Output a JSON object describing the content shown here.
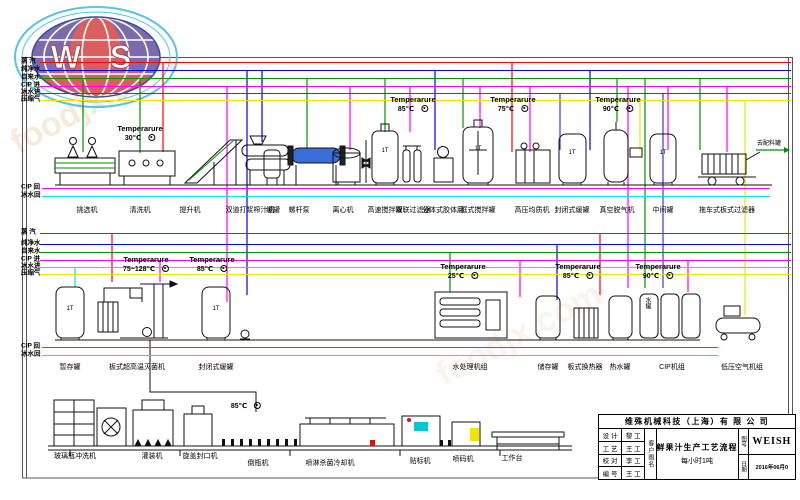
{
  "watermark": {
    "text": "foodjx.com"
  },
  "logo": {
    "letters": "W S"
  },
  "pipes": {
    "top": {
      "x1": 40,
      "x2": 791,
      "lines": [
        {
          "label": "蒸  汽",
          "color": "#ff0000",
          "y": 62
        },
        {
          "label": "纯净水",
          "color": "#0000ee",
          "y": 70
        },
        {
          "label": "自来水",
          "color": "#009100",
          "y": 78
        },
        {
          "label": "CIP 进",
          "color": "#ff00ff",
          "y": 86
        },
        {
          "label": "冰水进",
          "color": "#4a30e0",
          "y": 93
        },
        {
          "label": "压缩气",
          "color": "#f0e400",
          "y": 100
        }
      ]
    },
    "return_top": {
      "x1": 42,
      "x2": 770,
      "lines": [
        {
          "label": "CIP 回",
          "color": "#ff00ff",
          "y": 188
        },
        {
          "label": "冰水回",
          "color": "#00e5ee",
          "y": 196
        }
      ]
    },
    "mid": {
      "x1": 40,
      "x2": 791,
      "lines": [
        {
          "label": "蒸  汽",
          "color": "#ff0000",
          "y": 233
        },
        {
          "label": "纯净水",
          "color": "#0000ee",
          "y": 244
        },
        {
          "label": "自来水",
          "color": "#009100",
          "y": 252
        },
        {
          "label": "CIP 进",
          "color": "#ff00ff",
          "y": 260
        },
        {
          "label": "冰水进",
          "color": "#00e5ee",
          "y": 267
        },
        {
          "label": "压缩气",
          "color": "#f0e400",
          "y": 274
        }
      ]
    },
    "return_mid": {
      "x1": 42,
      "x2": 718,
      "lines": [
        {
          "label": "CIP 回",
          "color": "#ff00ff",
          "y": 347
        },
        {
          "label": "冰水回",
          "color": "#00e5ee",
          "y": 355
        }
      ]
    }
  },
  "equipment_row1": {
    "y": 207,
    "items": [
      {
        "text": "挑选机",
        "x": 87
      },
      {
        "text": "清洗机",
        "x": 140
      },
      {
        "text": "提升机",
        "x": 190
      },
      {
        "text": "双道打浆榨汁机",
        "x": 250
      },
      {
        "text": "缓罐",
        "x": 273
      },
      {
        "text": "螺杆泵",
        "x": 299
      },
      {
        "text": "离心机",
        "x": 343
      },
      {
        "text": "高速搅拌罐",
        "x": 385
      },
      {
        "text": "双联过滤器",
        "x": 413
      },
      {
        "text": "分体式胶体磨",
        "x": 443
      },
      {
        "text": "框式搅拌罐",
        "x": 478
      },
      {
        "text": "高压均质机",
        "x": 532
      },
      {
        "text": "封闭式缓罐",
        "x": 572
      },
      {
        "text": "真空脱气机",
        "x": 617
      },
      {
        "text": "中间罐",
        "x": 663
      },
      {
        "text": "拖车式板式过滤器",
        "x": 727
      }
    ]
  },
  "equipment_row2": {
    "y": 364,
    "items": [
      {
        "text": "暂存罐",
        "x": 70
      },
      {
        "text": "板式超高温灭菌机",
        "x": 137
      },
      {
        "text": "封闭式缓罐",
        "x": 216
      },
      {
        "text": "水处理机组",
        "x": 470
      },
      {
        "text": "储存罐",
        "x": 548
      },
      {
        "text": "板式换热器",
        "x": 585
      },
      {
        "text": "热水罐",
        "x": 620
      },
      {
        "text": "CIP机组",
        "x": 672
      },
      {
        "text": "低压空气机组",
        "x": 742
      }
    ]
  },
  "equipment_row3": {
    "items": [
      {
        "text": "玻璃瓶冲洗机",
        "x": 75,
        "y": 453
      },
      {
        "text": "灌装机",
        "x": 152,
        "y": 453
      },
      {
        "text": "旋盖封口机",
        "x": 200,
        "y": 453
      },
      {
        "text": "倒瓶机",
        "x": 258,
        "y": 460
      },
      {
        "text": "喷淋杀菌冷却机",
        "x": 330,
        "y": 460
      },
      {
        "text": "贴标机",
        "x": 420,
        "y": 458
      },
      {
        "text": "喷码机",
        "x": 463,
        "y": 456
      },
      {
        "text": "工作台",
        "x": 512,
        "y": 455
      }
    ]
  },
  "temps": {
    "title": "Temperarure",
    "items": [
      {
        "value": "30℃",
        "x": 140,
        "y": 124
      },
      {
        "value": "85℃",
        "x": 413,
        "y": 95
      },
      {
        "value": "75℃",
        "x": 513,
        "y": 95
      },
      {
        "value": "90℃",
        "x": 618,
        "y": 95
      },
      {
        "value": "75~128℃",
        "x": 146,
        "y": 255
      },
      {
        "value": "85℃",
        "x": 212,
        "y": 255
      },
      {
        "value": "25℃",
        "x": 463,
        "y": 262
      },
      {
        "value": "85℃",
        "x": 578,
        "y": 262
      },
      {
        "value": "90℃",
        "x": 658,
        "y": 262
      }
    ]
  },
  "bottom_temp": {
    "value": "85℃",
    "x": 246,
    "y": 401
  },
  "extras": {
    "tank_capacity": "1T",
    "tank_capacity_positions": [
      {
        "x": 385,
        "y": 148
      },
      {
        "x": 478,
        "y": 146
      },
      {
        "x": 572,
        "y": 150
      },
      {
        "x": 663,
        "y": 150
      },
      {
        "x": 70,
        "y": 306
      },
      {
        "x": 216,
        "y": 306
      }
    ],
    "to_tank": "去配料罐",
    "to_tank_pos": {
      "x": 769,
      "y": 141
    },
    "water_tank": "水罐",
    "water_tank_pos": {
      "x": 644,
      "y": 297
    }
  },
  "titleblock": {
    "company": "维殊机械科技（上海）有 限 公 司",
    "rows": [
      {
        "k": "设 计",
        "v": "黎 工"
      },
      {
        "k": "工 艺",
        "v": "王 工"
      },
      {
        "k": "校 对",
        "v": "李 工"
      },
      {
        "k": "编 号",
        "v": "王 工"
      }
    ],
    "col_customer": "客户图名",
    "drawing_title_line1": "鲜果汁生产工艺流程",
    "drawing_title_line2": "每小时1吨",
    "col_no_date": [
      "图号",
      "日期"
    ],
    "drawing_no": "WEISH",
    "date": "2016年06月0"
  }
}
